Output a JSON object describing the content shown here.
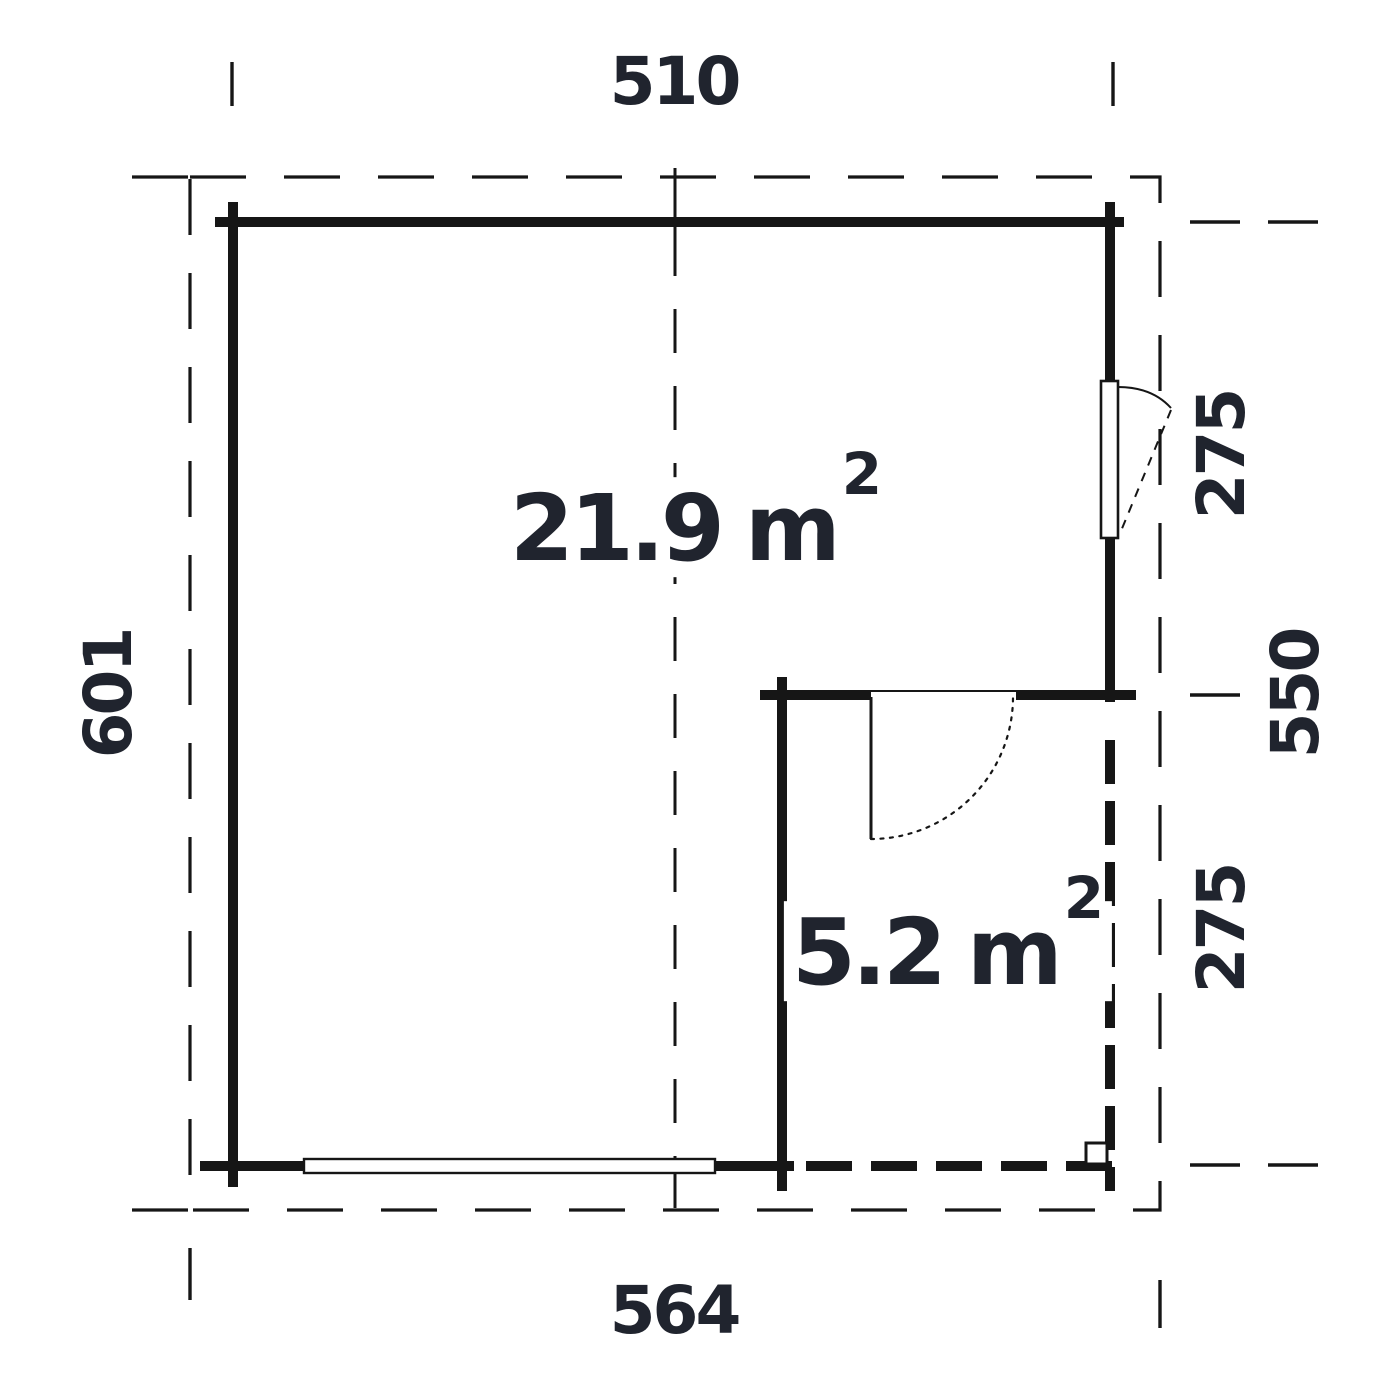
{
  "floor_plan": {
    "dimensions_cm": {
      "top_width": "510",
      "left_height": "601",
      "bottom_width": "564",
      "right_upper": "275",
      "right_total": "550",
      "right_lower": "275"
    },
    "rooms": {
      "main": {
        "area": "21.9",
        "unit": "m",
        "exponent": "2"
      },
      "annex": {
        "area": "5.2",
        "unit": "m",
        "exponent": "2"
      }
    },
    "colors": {
      "line": "#161616",
      "label_text": "#20242e",
      "background": "#ffffff"
    }
  }
}
